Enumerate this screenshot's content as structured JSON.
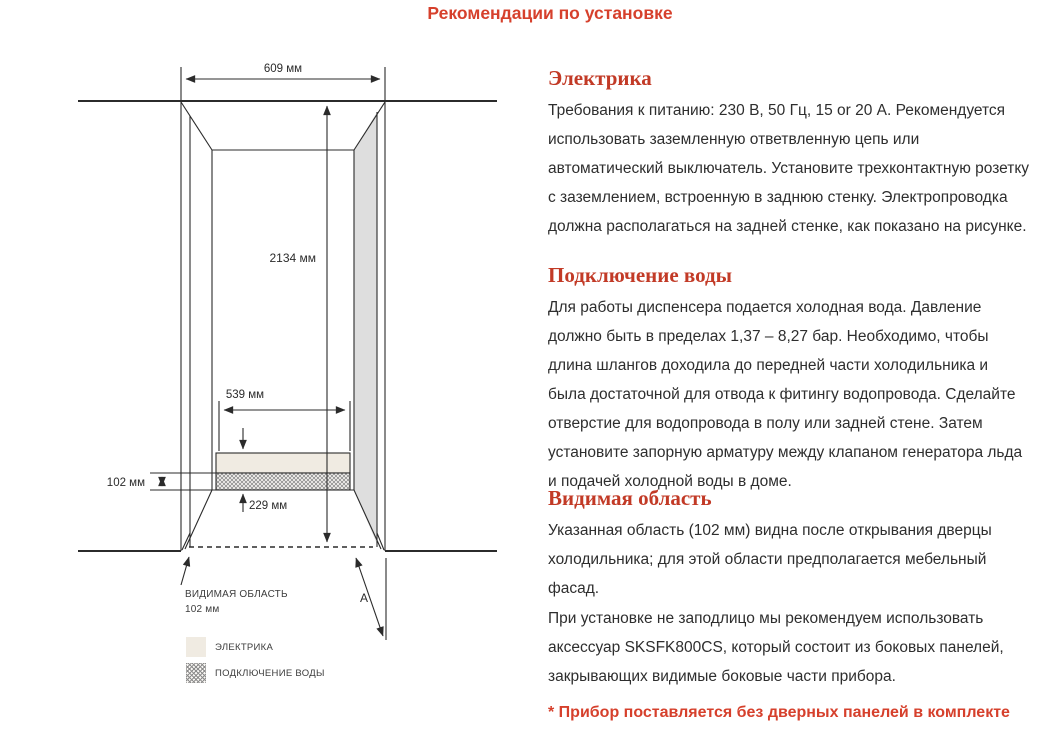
{
  "page": {
    "title": "Рекомендации по установке"
  },
  "colors": {
    "title_red": "#d6402c",
    "heading_red": "#c23a26",
    "electrics_fill": "#f0ebe2",
    "side_panel_gray": "#dedede",
    "line_color": "#2b2b2b"
  },
  "diagram": {
    "dims": {
      "width_top": "609 мм",
      "height": "2134 мм",
      "inner_width": "539 мм",
      "visible_depth": "102 мм",
      "bottom_offset": "229 мм"
    },
    "visible_area": {
      "line1": "ВИДИМАЯ ОБЛАСТЬ",
      "line2": "102 мм"
    },
    "marker_a": "А",
    "legend": [
      {
        "label": "ЭЛЕКТРИКА"
      },
      {
        "label": "ПОДКЛЮЧЕНИЕ ВОДЫ"
      }
    ]
  },
  "sections": [
    {
      "heading": "Электрика",
      "body": "Требования к питанию: 230 В, 50 Гц, 15 or 20 А. Рекомендуется использовать заземленную ответвленную цепь или автоматический выключатель. Установите трехконтактную розетку с заземлением, встроенную в заднюю стенку. Электропроводка должна располагаться на задней стенке, как показано на рисунке."
    },
    {
      "heading": "Подключение воды",
      "body": "Для работы диспенсера подается холодная вода. Давление должно быть в пределах 1,37 – 8,27 бар. Необходимо, чтобы длина шлангов доходила до передней части холодильника и была достаточной для отвода к фитингу водопровода. Сделайте отверстие для водопровода в полу или задней стене. Затем установите запорную арматуру между клапаном генератора льда и подачей холодной воды в доме."
    },
    {
      "heading": "Видимая область",
      "body": "Указанная область (102 мм) видна после открывания дверцы холодильника; для этой области предполагается мебельный фасад.",
      "body2": "При установке не заподлицо мы рекомендуем использовать аксессуар SKSFK800CS, который состоит из боковых панелей, закрывающих видимые боковые части прибора."
    }
  ],
  "footnote": "* Прибор поставляется без дверных панелей в комплекте"
}
